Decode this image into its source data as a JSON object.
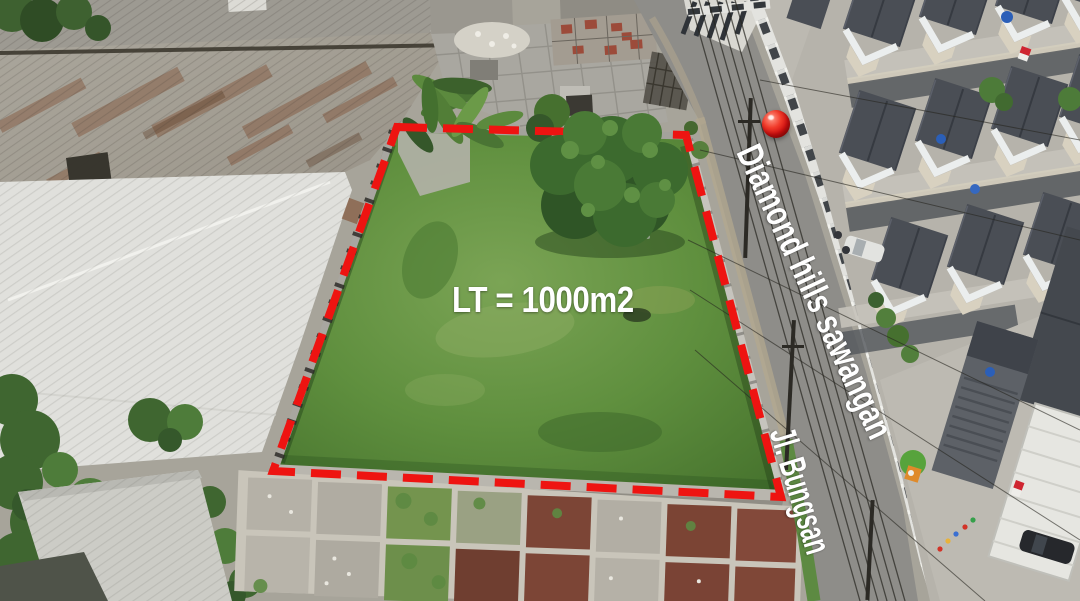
{
  "annotations": {
    "area_label": "LT = 1000m2",
    "street_name_primary": "Diamond hills sawangan",
    "street_name_secondary": "Jl. Bungsan"
  },
  "marker": {
    "pin": "red-location-pin"
  },
  "colors": {
    "boundary": "#ee1411",
    "pin": "#e01414",
    "label_text": "#ffffff",
    "grass": "#5f8f3e",
    "road": "#8e8d89"
  }
}
